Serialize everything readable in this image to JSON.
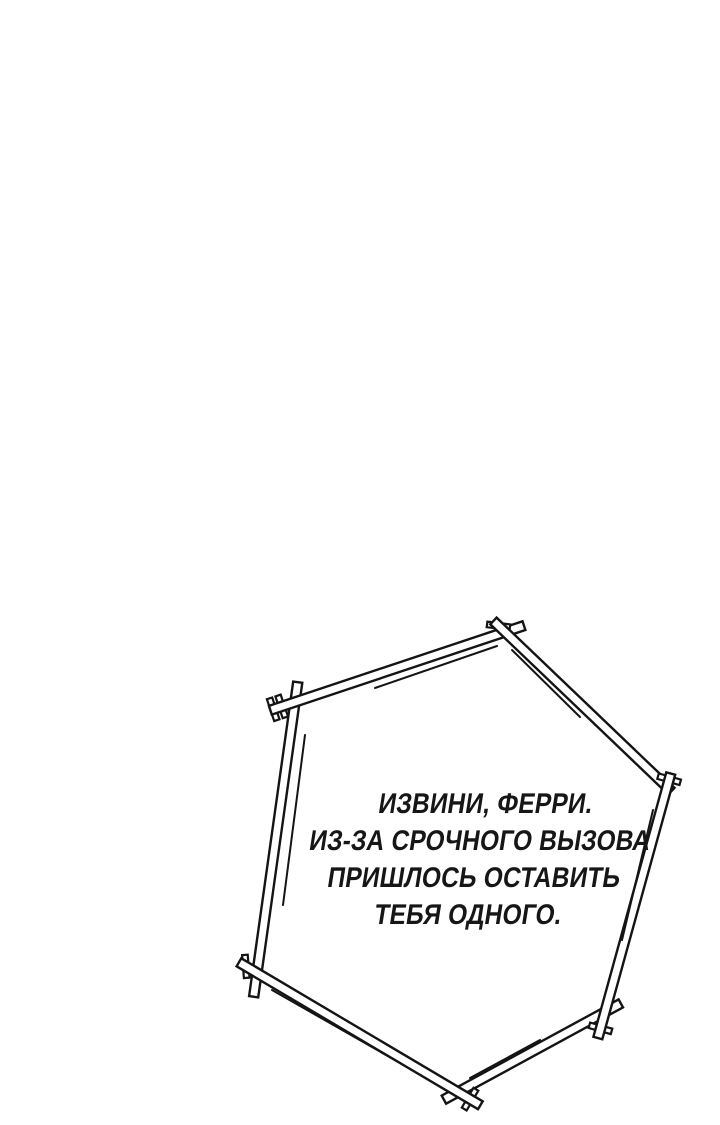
{
  "page": {
    "background_color": "#ffffff"
  },
  "bubble": {
    "type": "hexagonal-sketch-speech-frame",
    "stroke_color": "#141414",
    "fill_color": "#ffffff",
    "text_color": "#161616",
    "lines": [
      "ИЗВИНИ, ФЕРРИ.",
      "ИЗ-ЗА СРОЧНОГО ВЫЗОВА",
      "ПРИШЛОСЬ ОСТАВИТЬ",
      "ТЕБЯ ОДНОГО."
    ]
  }
}
